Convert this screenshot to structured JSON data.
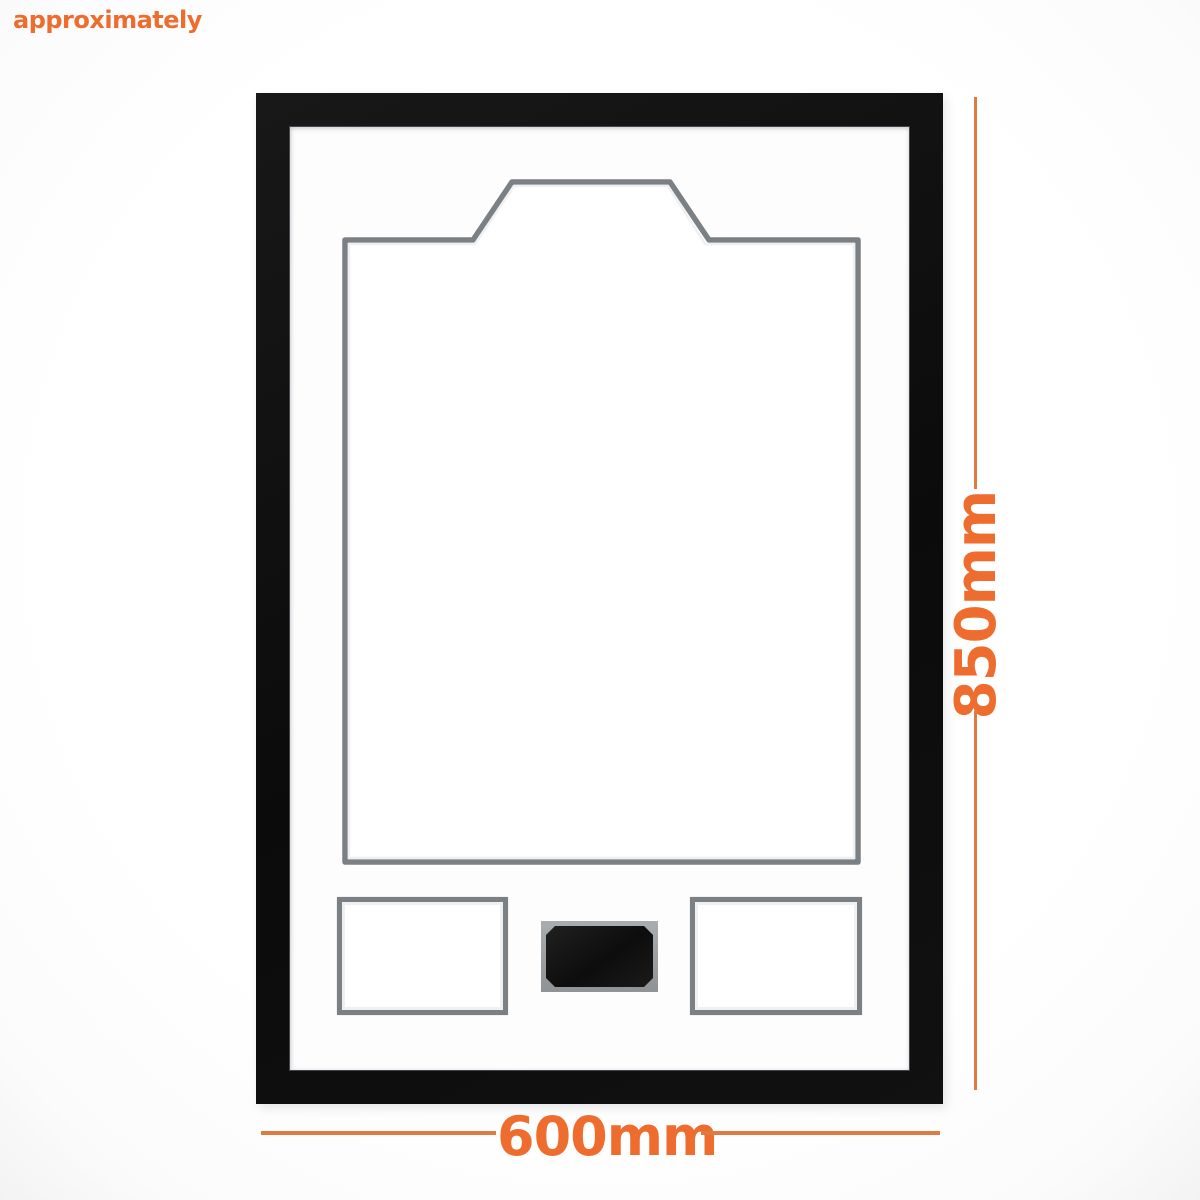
{
  "annotation": {
    "approx_label": "approximately",
    "height_label": "850mm",
    "width_label": "600mm"
  },
  "colors": {
    "accent": "#ed6c2e",
    "dim-line": "#df7a42",
    "frame-black": "#101010",
    "mat-white": "#fdfdfd",
    "cutout-gray": "#7b8085",
    "cutout-bevel": "#eef0f1",
    "plaque-plate-gray": "#9fa2a5",
    "plaque-black": "#161616"
  }
}
